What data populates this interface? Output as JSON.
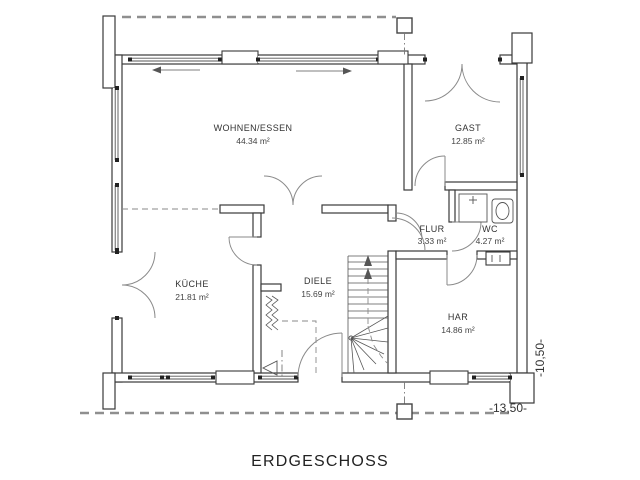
{
  "title": "ERDGESCHOSS",
  "floor_plan": {
    "rooms": [
      {
        "id": "wohnen",
        "name": "WOHNEN/ESSEN",
        "area": "44.34 m²"
      },
      {
        "id": "gast",
        "name": "GAST",
        "area": "12.85 m²"
      },
      {
        "id": "kueche",
        "name": "KÜCHE",
        "area": "21.81 m²"
      },
      {
        "id": "diele",
        "name": "DIELE",
        "area": "15.69 m²"
      },
      {
        "id": "flur",
        "name": "FLUR",
        "area": "3.33 m²"
      },
      {
        "id": "wc",
        "name": "WC",
        "area": "4.27 m²"
      },
      {
        "id": "har",
        "name": "HAR",
        "area": "14.86 m²"
      }
    ],
    "dimensions": {
      "horizontal": "-13,50-",
      "vertical": "-10,50-"
    },
    "symbols": [
      "stairs",
      "shower",
      "toilet",
      "washbasin",
      "entrance-arrow",
      "sliding-window-arrows",
      "roof-outline-dashed",
      "column-marker",
      "shaft-zigzag"
    ],
    "colors": {
      "wall_line": "#3a3a3a",
      "thin_line": "#555555",
      "door_arc": "#8a8a8a",
      "dashed_outline": "#8f8f8f",
      "text": "#333333",
      "background": "#ffffff"
    }
  }
}
